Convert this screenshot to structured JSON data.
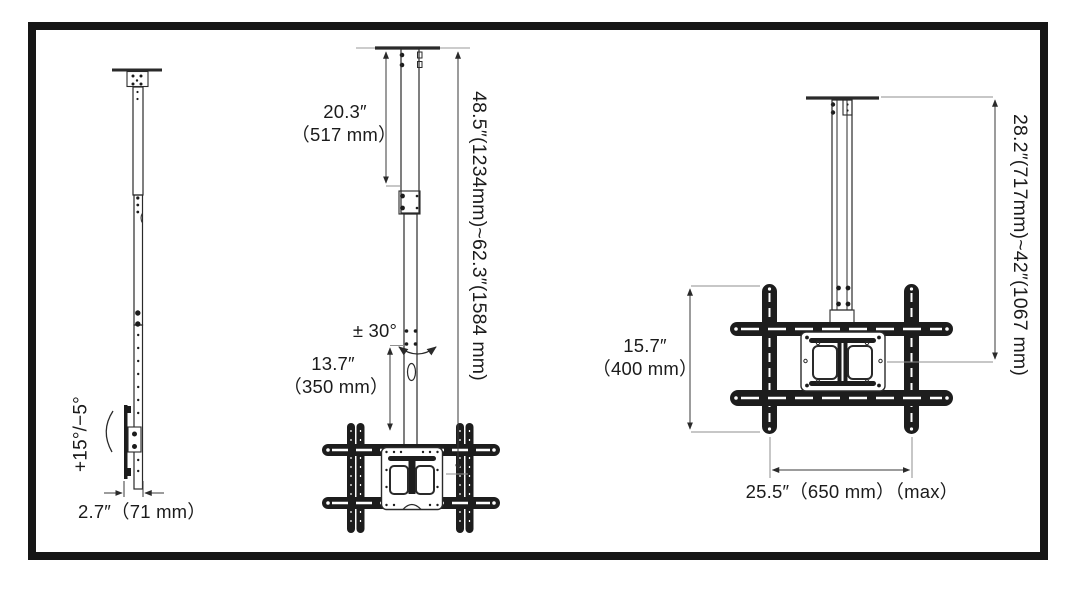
{
  "meta": {
    "description": "TV ceiling mount dimension diagram, three orthographic views",
    "background_color": "#ffffff",
    "frame_color": "#161616",
    "line_color": "#262626"
  },
  "views": {
    "side": {
      "tilt_range": "+15°/−5°",
      "depth": "2.7″（71 mm）"
    },
    "front_extended": {
      "upper_pole_in": "20.3″",
      "upper_pole_mm": "（517 mm）",
      "overall_range": "48.5″(1234mm)~62.3″(1584 mm)",
      "swivel_range": "± 30°",
      "lower_pole_in": "13.7″",
      "lower_pole_mm": "（350 mm）"
    },
    "front_retracted": {
      "bracket_height_in": "15.7″",
      "bracket_height_mm": "（400 mm）",
      "drop_range": "28.2″(717mm)~42″(1067 mm)",
      "bracket_width": "25.5″（650 mm）（max）"
    }
  }
}
